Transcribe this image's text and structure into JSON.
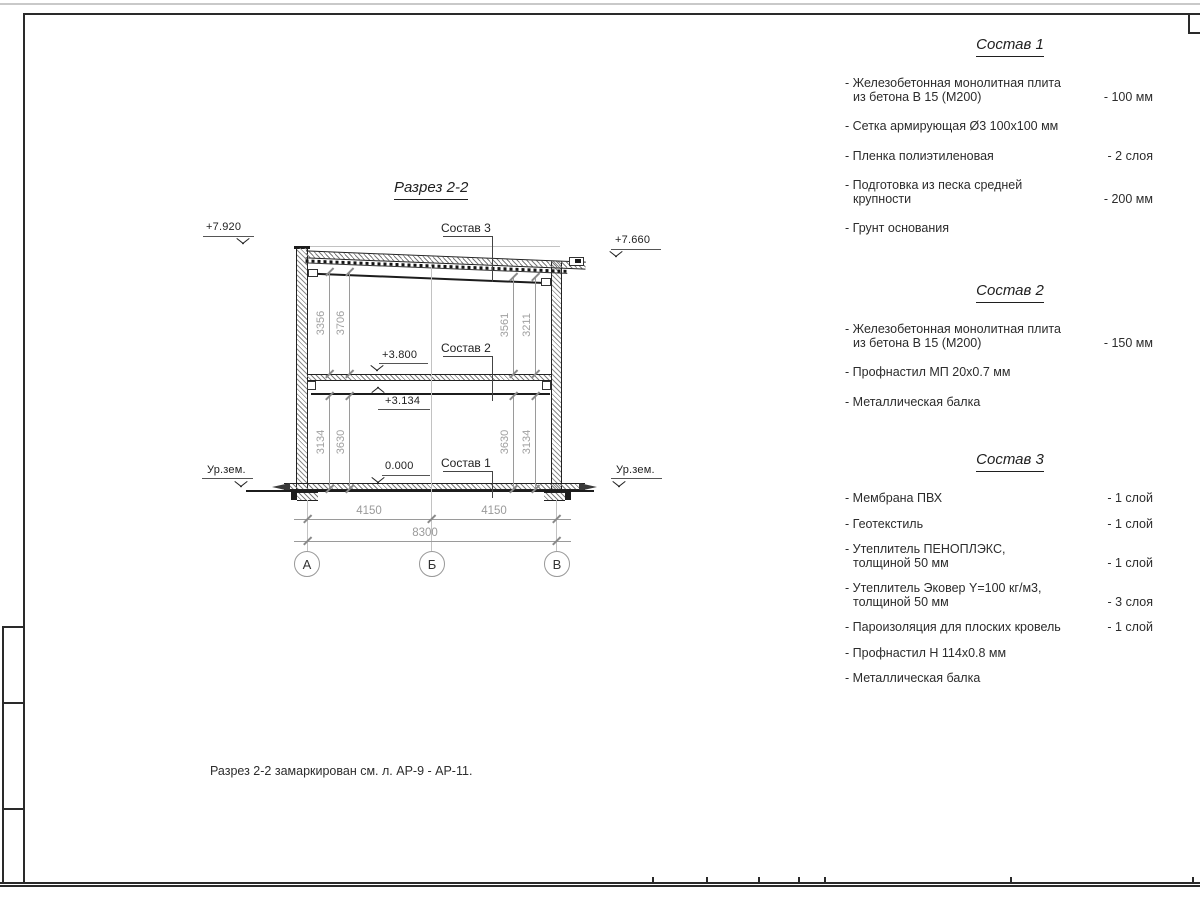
{
  "sheet": {
    "note": "Разрез 2-2 замаркирован см. л. АР-9 - АР-11."
  },
  "drawing": {
    "title": "Разрез 2-2",
    "elevations": {
      "roof_left": "+7.920",
      "roof_right": "+7.660",
      "floor2": "+3.800",
      "beam": "+3.134",
      "floor1": "0.000",
      "ground_left": "Ур.зем.",
      "ground_right": "Ур.зем."
    },
    "layer_labels": {
      "c1": "Состав 1",
      "c2": "Состав 2",
      "c3": "Состав 3"
    },
    "dims": {
      "span_left": "4150",
      "span_right": "4150",
      "span_total": "8300",
      "upper_left_1": "3356",
      "upper_left_2": "3706",
      "upper_right_1": "3561",
      "upper_right_2": "3211",
      "lower_left_1": "3134",
      "lower_left_2": "3630",
      "lower_right_1": "3630",
      "lower_right_2": "3134"
    },
    "grid": {
      "a": "А",
      "b": "Б",
      "v": "В"
    }
  },
  "compositions": [
    {
      "title": "Состав 1",
      "items": [
        {
          "l1": "- Железобетонная  монолитная плита",
          "l2": "из бетона В 15 (М200)",
          "qty": "- 100 мм"
        },
        {
          "l1": "- Сетка армирующая Ø3 100х100 мм",
          "qty": ""
        },
        {
          "l1": "- Пленка полиэтиленовая",
          "qty": "- 2 слоя"
        },
        {
          "l1": "- Подготовка из песка средней",
          "l2": "крупности",
          "qty": "- 200 мм"
        },
        {
          "l1": "- Грунт основания",
          "qty": ""
        }
      ]
    },
    {
      "title": "Состав 2",
      "items": [
        {
          "l1": "- Железобетонная  монолитная плита",
          "l2": "из бетона В 15 (М200)",
          "qty": "- 150 мм"
        },
        {
          "l1": "- Профнастил МП 20х0.7 мм",
          "qty": ""
        },
        {
          "l1": "- Металлическая балка",
          "qty": ""
        }
      ]
    },
    {
      "title": "Состав 3",
      "items": [
        {
          "l1": "- Мембрана ПВХ",
          "qty": "- 1 слой"
        },
        {
          "l1": "- Геотекстиль",
          "qty": "- 1 слой"
        },
        {
          "l1": "- Утеплитель ПЕНОПЛЭКС,",
          "l2": "толщиной 50 мм",
          "qty": "- 1 слой"
        },
        {
          "l1": "- Утеплитель Эковер Y=100 кг/м3,",
          "l2": "толщиной 50 мм",
          "qty": "- 3 слоя"
        },
        {
          "l1": "- Пароизоляция для плоских кровель",
          "qty": "- 1 слой"
        },
        {
          "l1": "- Профнастил Н 114х0.8 мм",
          "qty": ""
        },
        {
          "l1": "- Металлическая балка",
          "qty": ""
        }
      ]
    }
  ]
}
